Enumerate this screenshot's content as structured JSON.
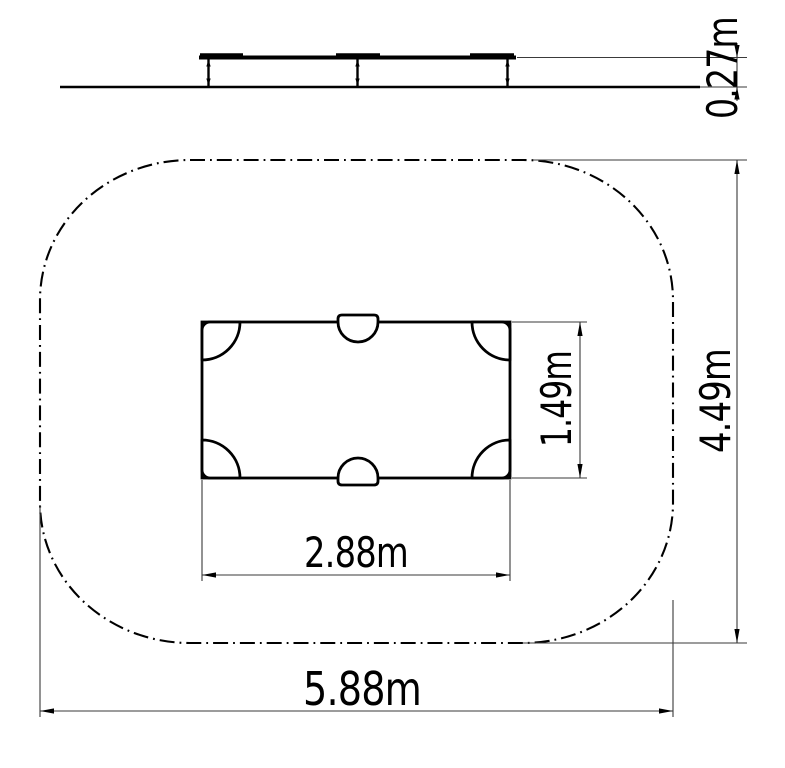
{
  "drawing": {
    "type": "playground-equipment-plan-and-elevation",
    "dimensions": {
      "platform_height": "0.27m",
      "equipment_depth": "1.49m",
      "equipment_width": "2.88m",
      "safety_zone_depth": "4.49m",
      "safety_zone_width": "5.88m"
    },
    "colors": {
      "structure_line": "#000000",
      "dimension_line": "#3a3a3a",
      "background": "#ffffff"
    }
  }
}
